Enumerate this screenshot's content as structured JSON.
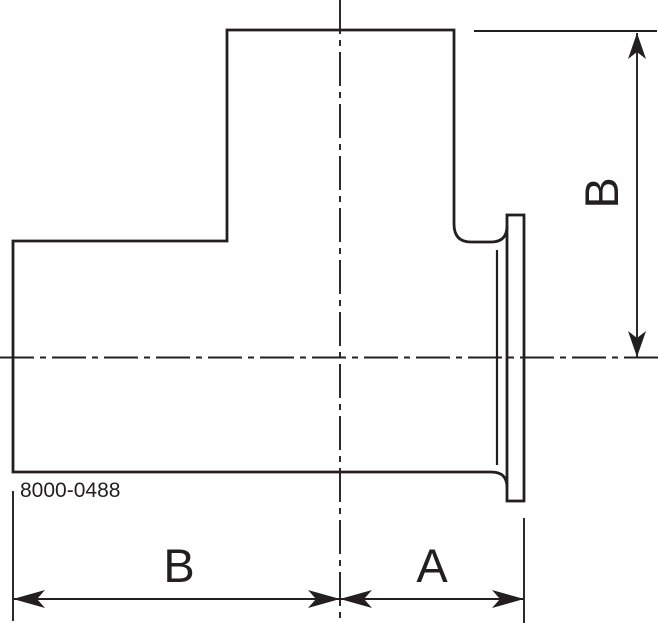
{
  "drawing": {
    "title": "Tee fitting with clamp ferrule - dimensioned side view",
    "part_number": "8000-0488",
    "dimensions": [
      {
        "name": "vertical-right",
        "label": "B"
      },
      {
        "name": "horizontal-left",
        "label": "B"
      },
      {
        "name": "horizontal-right",
        "label": "A"
      }
    ],
    "colors": {
      "line": "#231f20",
      "background": "#ffffff"
    }
  }
}
